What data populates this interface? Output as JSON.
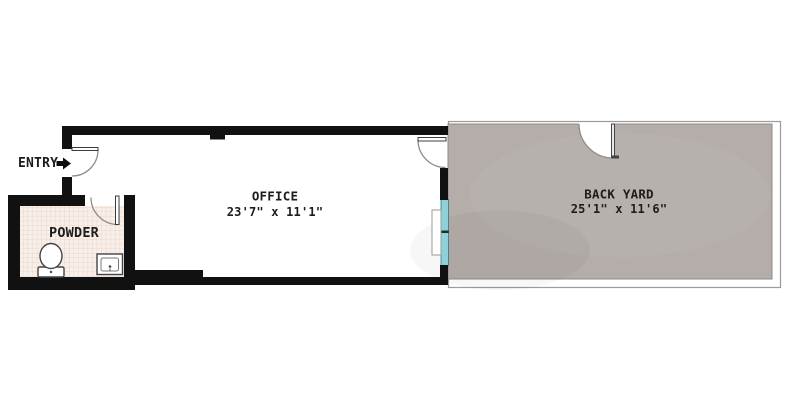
{
  "entry": {
    "label": "ENTRY"
  },
  "rooms": {
    "powder": {
      "name": "POWDER"
    },
    "office": {
      "name": "OFFICE",
      "dims": "23'7\" x 11'1\""
    },
    "backyard": {
      "name": "BACK YARD",
      "dims": "25'1\" x 11'6\""
    }
  },
  "features": {
    "entry_arrow": "right-arrow",
    "doors": [
      "entry-door",
      "powder-door",
      "office-backyard-door",
      "backyard-gate"
    ],
    "window": "office-backyard-window",
    "fixtures": [
      "toilet",
      "sink"
    ]
  },
  "colors": {
    "wall": "#111111",
    "backyard_fill": "#b4adaa",
    "backyard_line": "#8f8b89",
    "outer_line": "#9b9b9b",
    "window_glass": "#8fd1d8",
    "window_frame": "#37757d",
    "window_divider": "#1f2b2d",
    "tile_bg": "#f8efe9",
    "tile_line": "#e9d7cc",
    "door_line": "#8c8c8c",
    "leaf_line": "#3c3c3c",
    "fixture_line": "#444444",
    "text_color": "#1c1c1c"
  }
}
